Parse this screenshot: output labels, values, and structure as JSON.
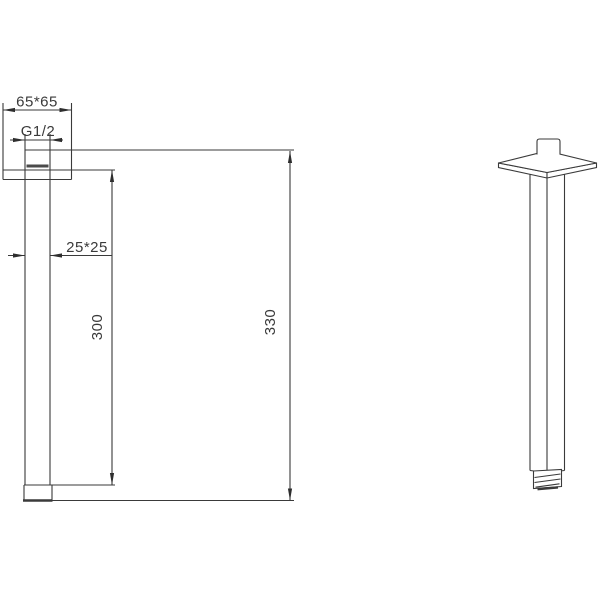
{
  "canvas": {
    "background": "#ffffff",
    "line_color": "#3a3a3a",
    "width": 600,
    "height": 600
  },
  "drawing": {
    "title": "ceiling-mount square shower arm - dimensioned drawing",
    "views": [
      "front-section",
      "perspective"
    ],
    "dimensions": {
      "flange_size": "65*65",
      "thread_size": "G1/2",
      "tube_size": "25*25",
      "tube_length": "300",
      "overall_length": "330"
    }
  }
}
